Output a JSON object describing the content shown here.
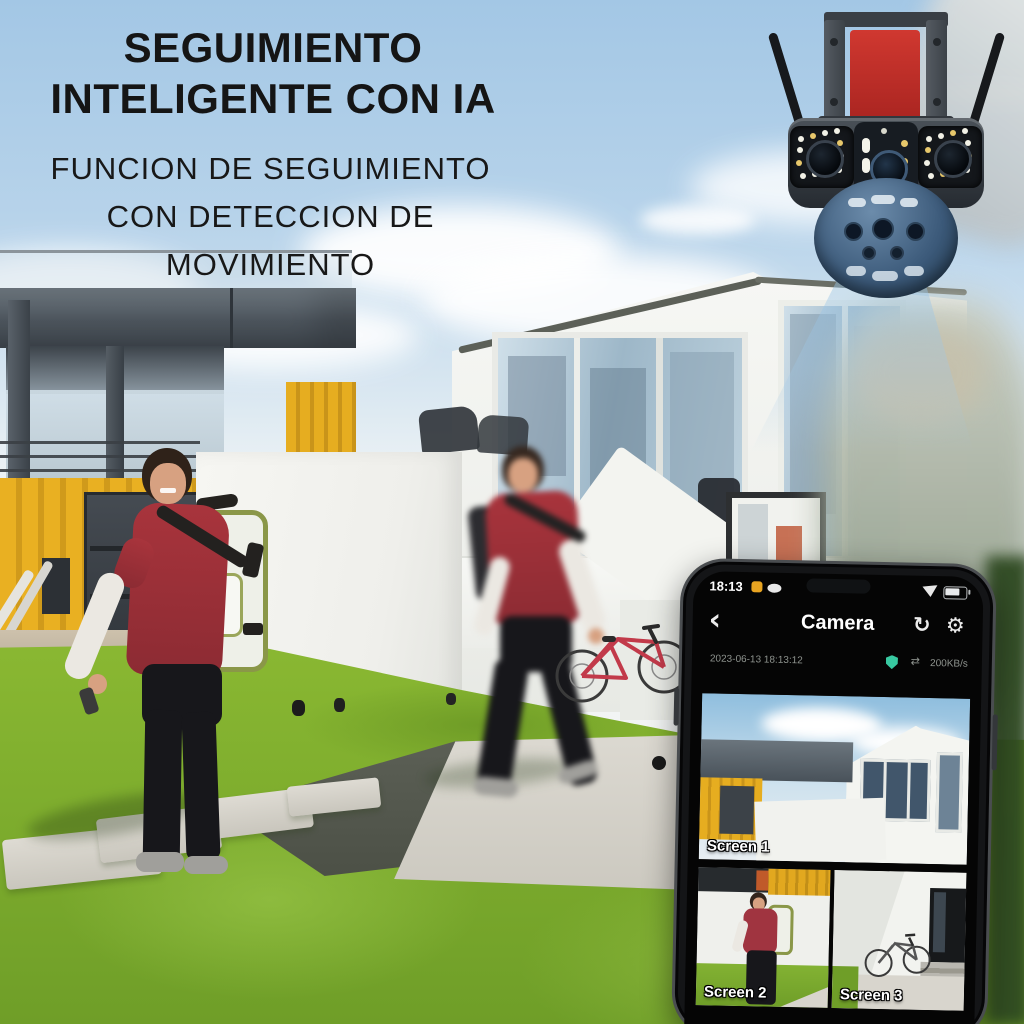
{
  "header": {
    "title_line1": "SEGUIMIENTO",
    "title_line2": "INTELIGENTE CON IA",
    "subtitle_line1": "FUNCION DE SEGUIMIENTO",
    "subtitle_line2": "CON DETECCION DE",
    "subtitle_line3": "MOVIMIENTO"
  },
  "phone": {
    "status_bar": {
      "time": "18:13"
    },
    "app_bar": {
      "back_glyph": "‹",
      "title": "Camera",
      "refresh_glyph": "↻",
      "settings_glyph": "⚙"
    },
    "stream_info": {
      "timestamp": "2023-06-13 18:13:12",
      "transfer_glyph": "⇄",
      "speed": "200KB/s"
    },
    "screens": [
      {
        "label": "Screen 1"
      },
      {
        "label": "Screen 2"
      },
      {
        "label": "Screen 3"
      }
    ]
  },
  "colors": {
    "sky_blue": "#a6c9e6",
    "grass_green": "#7fae2e",
    "container_yellow": "#e2a81f",
    "shirt_red": "#a8343c",
    "camera_mount_red": "#c13028",
    "beam_blue": "rgba(150,195,230,0.5)",
    "shield_teal": "#38c9a1",
    "phone_black": "#141517"
  }
}
